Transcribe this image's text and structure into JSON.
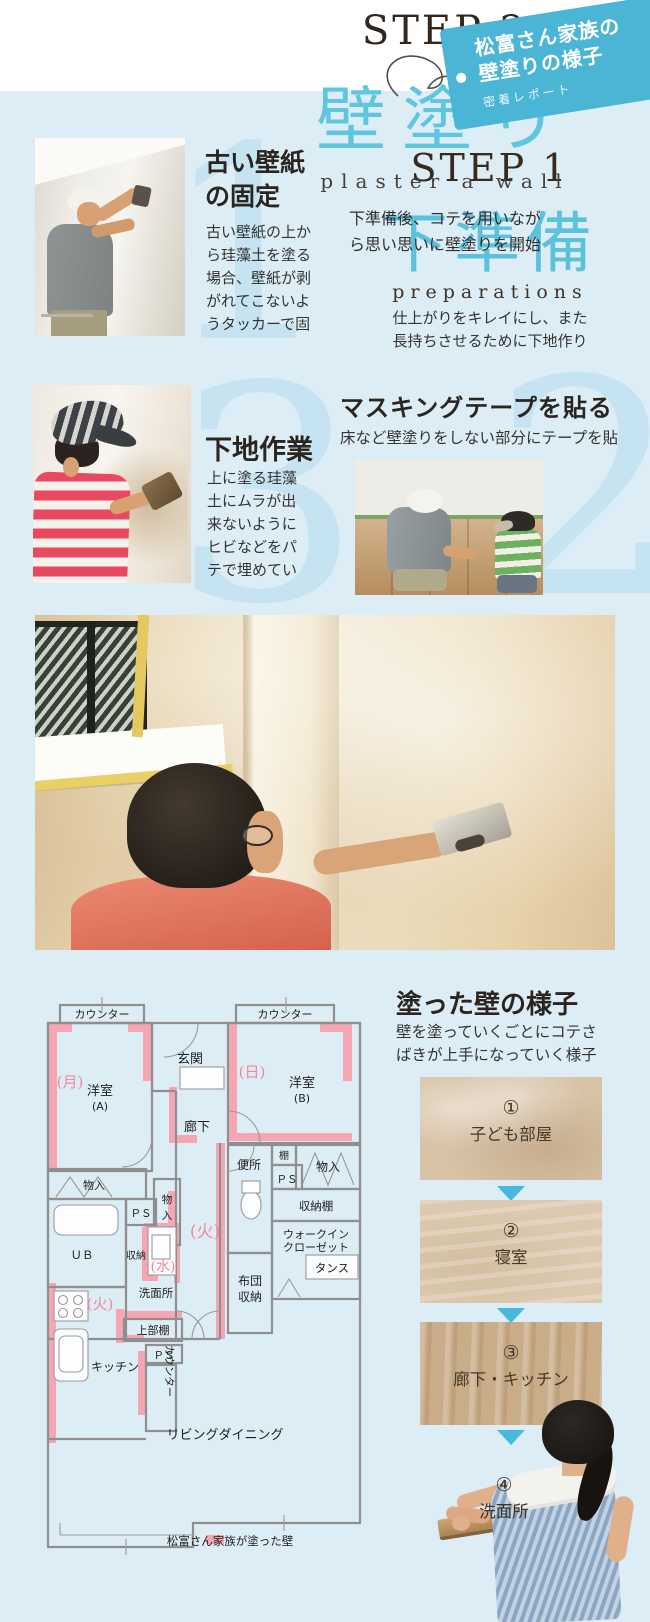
{
  "page": {
    "panel_color": "#ddedf5",
    "tag_color": "#4bb5d5",
    "headline_cyan": "#5cc1db",
    "numeral_blue": "#c5e3f0",
    "painted_wall_pink": "#f5a6b2"
  },
  "tag": {
    "title_line1": "松富さん家族の",
    "title_line2": "壁塗りの様子",
    "subtitle": "密着レポート"
  },
  "step1": {
    "label": "STEP 1",
    "title": "下準備",
    "title_en": "preparations",
    "desc_line1": "仕上がりをキレイにし、また",
    "desc_line2": "長持ちさせるために下地作り"
  },
  "item1": {
    "number": "1",
    "title_line1": "古い壁紙",
    "title_line2": "の固定",
    "body": [
      "古い壁紙の上か",
      "ら珪藻土を塗る",
      "場合、壁紙が剥",
      "がれてこないよ",
      "うタッカーで固"
    ]
  },
  "item2": {
    "number": "2",
    "title": "マスキングテープを貼る",
    "subtitle": "床など壁塗りをしない部分にテープを貼"
  },
  "item3": {
    "number": "3",
    "title": "下地作業",
    "body": [
      "上に塗る珪藻",
      "土にムラが出",
      "来ないように",
      "ヒビなどをパ",
      "テで埋めてい"
    ]
  },
  "step2": {
    "label": "STEP 2",
    "title": "壁塗り",
    "title_en": "plaster a wall",
    "desc_line1": "下準備後、コテを用いなが",
    "desc_line2": "ら思い思いに壁塗りを開始"
  },
  "painted": {
    "title": "塗った壁の様子",
    "desc_line1": "壁を塗っていくごとにコテさ",
    "desc_line2": "ばきが上手になっていく様子"
  },
  "samples": [
    {
      "number": "①",
      "label": "子ども部屋"
    },
    {
      "number": "②",
      "label": "寝室"
    },
    {
      "number": "③",
      "label": "廊下・キッチン"
    },
    {
      "number": "④",
      "label": "洗面所"
    }
  ],
  "plan": {
    "counter_a": "カウンター",
    "counter_b": "カウンター",
    "room_a": "洋室",
    "room_a_sub": "(A)",
    "mark_mon": "(月)",
    "genkan": "玄関",
    "room_b": "洋室",
    "room_b_sub": "(B)",
    "mark_nichi": "(日)",
    "rouka": "廊下",
    "benjo": "便所",
    "tana": "棚",
    "ps_1": "ＰＳ",
    "monoire_right": "物入",
    "shunou_dana": "収納棚",
    "walkin_1": "ウォークイン",
    "walkin_2": "クローゼット",
    "tansu": "タンス",
    "futon_1": "布団",
    "futon_2": "収納",
    "mark_ka_hall": "(火)",
    "monoire_left": "物入",
    "monoire_mid_1": "物",
    "monoire_mid_2": "入",
    "ps_2": "ＰＳ",
    "ub": "ＵＢ",
    "shunou": "収納",
    "mark_mizu": "(水)",
    "senmenjo": "洗面所",
    "mark_ka_kitchen": "(火)",
    "joubu_dana": "上部棚",
    "ps_3": "ＰＳ",
    "kitchen": "キッチン",
    "counter_kitchen": "カウンター",
    "living": "リビングダイニング",
    "legend": "松富さん家族が塗った壁"
  }
}
